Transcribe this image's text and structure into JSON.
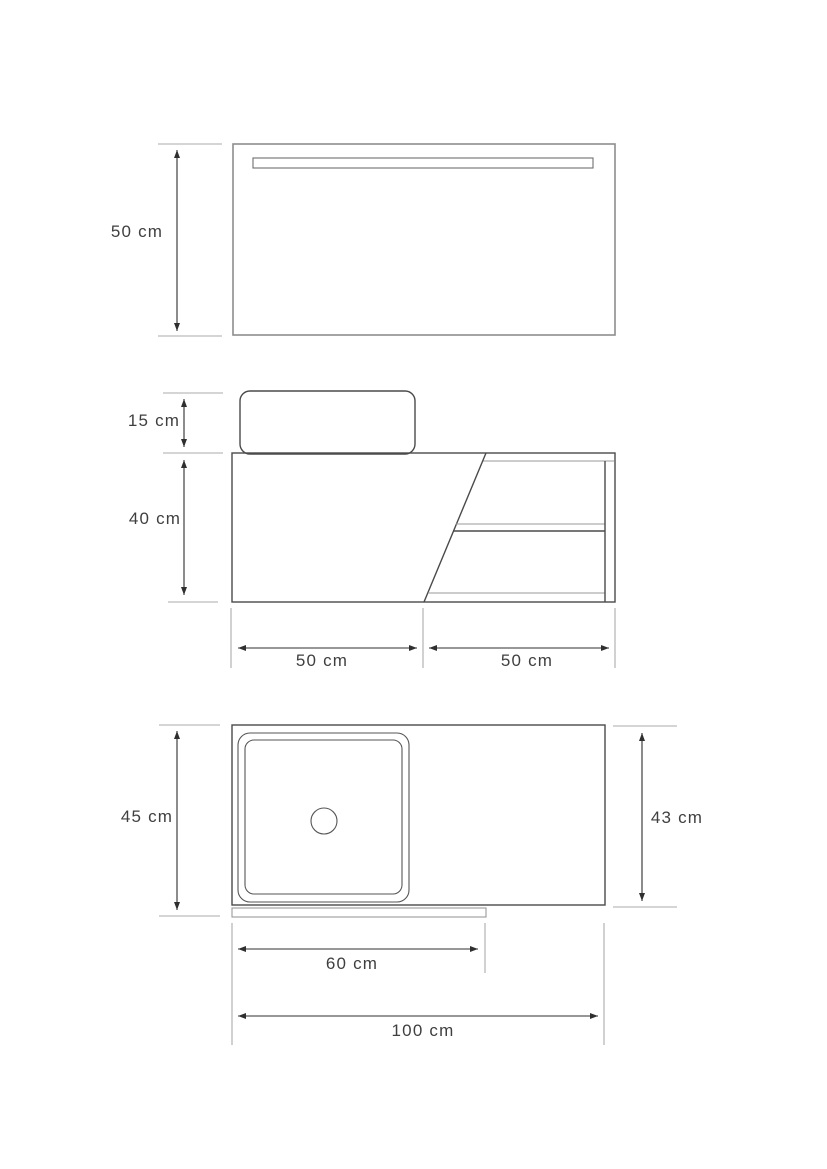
{
  "title": "Bathroom vanity technical drawing",
  "colors": {
    "background": "#ffffff",
    "outline_gray": "#8d8d8d",
    "outline_dark": "#4a4a4a",
    "dimension_line": "#2f2f2f",
    "extension_line": "#ababab",
    "label_text": "#3f3f3f"
  },
  "views": {
    "mirror_front": {
      "name": "mirror front view",
      "dimensions": {
        "height": "50 cm"
      }
    },
    "vanity_front": {
      "name": "vanity front view",
      "dimensions": {
        "basin_height": "15 cm",
        "cabinet_height": "40 cm",
        "left_section_width": "50 cm",
        "right_section_width": "50 cm"
      }
    },
    "vanity_top": {
      "name": "vanity top view",
      "dimensions": {
        "total_depth": "45 cm",
        "countertop_depth": "43 cm",
        "cabinet_width": "60 cm",
        "total_width": "100 cm"
      }
    }
  }
}
